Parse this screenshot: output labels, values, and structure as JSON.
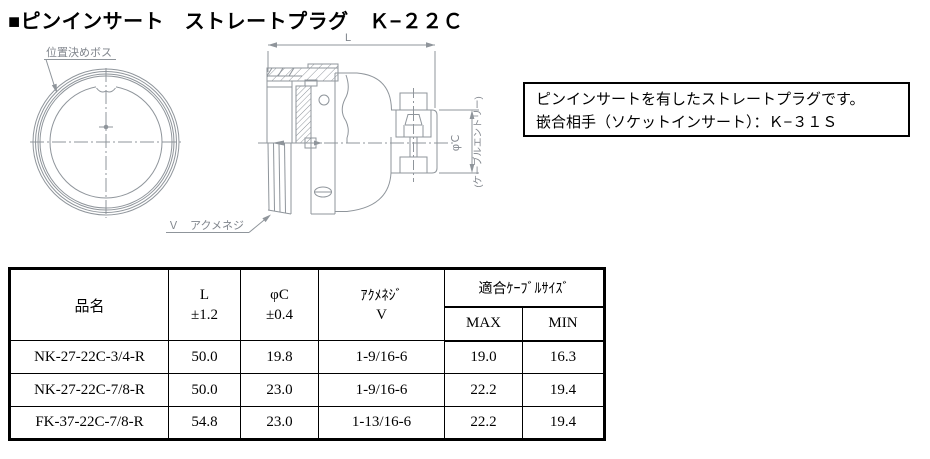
{
  "page": {
    "title": "■ピンインサート　ストレートプラグ　Ｋ−２２Ｃ"
  },
  "info_box": {
    "line1": "ピンインサートを有したストレートプラグです。",
    "line2": "嵌合相手（ソケットインサート）：Ｋ−３１Ｓ"
  },
  "drawing": {
    "line_color": "#8f959b",
    "label_color": "#81868d",
    "labels": {
      "positioning_boss": "位置決めボス",
      "dim_L": "L",
      "dim_phiC": "φＣ",
      "cable_entry": "(ケーブルエントリー)",
      "acme_thread": "Ｖ　アクメネジ"
    }
  },
  "table": {
    "headers": {
      "name": "品名",
      "L_line1": "L",
      "L_line2": "±1.2",
      "phiC_line1": "φC",
      "phiC_line2": "±0.4",
      "acme_line1": "ｱｸﾒﾈｼﾞ",
      "acme_line2": "V",
      "cable_size": "適合ｹｰﾌﾞﾙｻｲｽﾞ",
      "max": "MAX",
      "min": "MIN"
    },
    "rows": [
      {
        "name": "NK-27-22C-3/4-R",
        "L": "50.0",
        "phiC": "19.8",
        "acme": "1-9/16-6",
        "max": "19.0",
        "min": "16.3"
      },
      {
        "name": "NK-27-22C-7/8-R",
        "L": "50.0",
        "phiC": "23.0",
        "acme": "1-9/16-6",
        "max": "22.2",
        "min": "19.4"
      },
      {
        "name": "FK-37-22C-7/8-R",
        "L": "54.8",
        "phiC": "23.0",
        "acme": "1-13/16-6",
        "max": "22.2",
        "min": "19.4"
      }
    ]
  }
}
